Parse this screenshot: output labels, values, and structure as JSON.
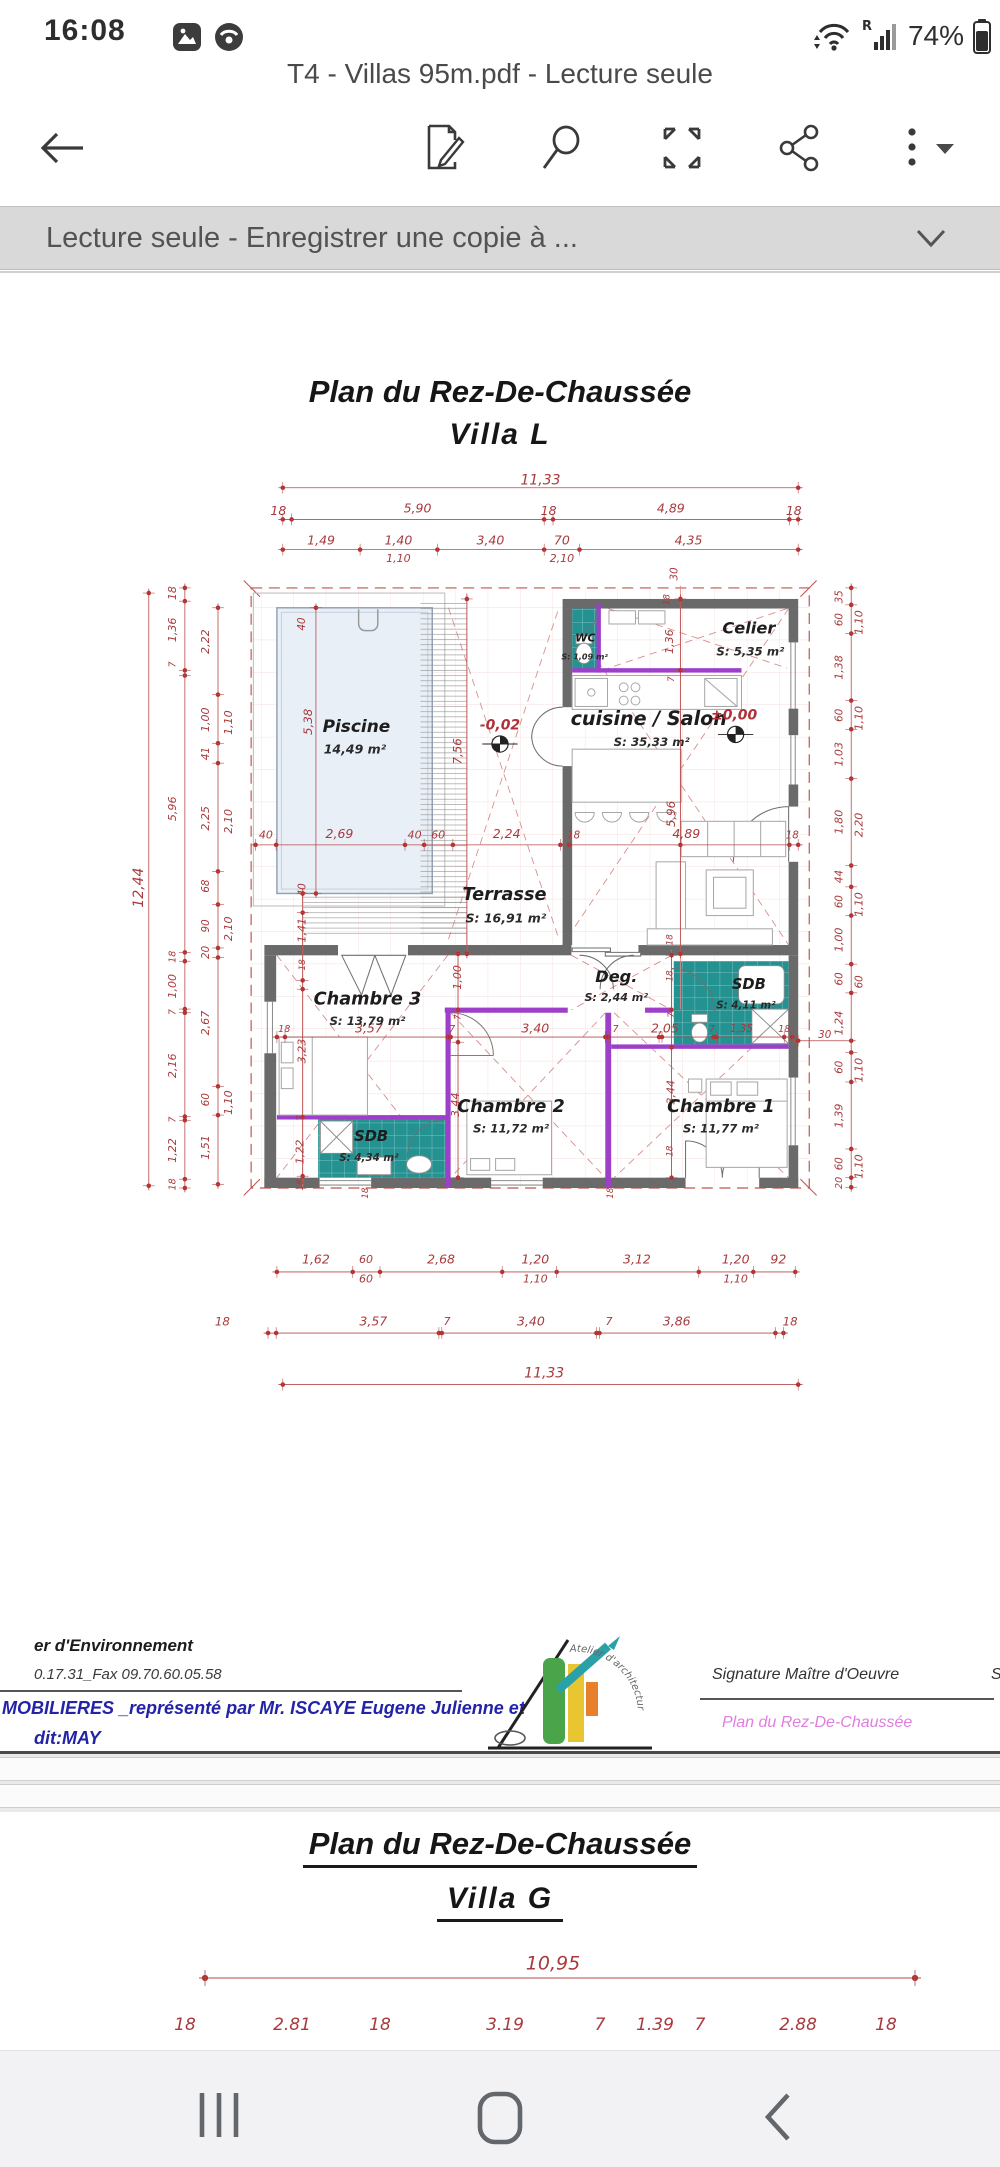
{
  "status_bar": {
    "time": "16:08",
    "battery_pct": "74%"
  },
  "window": {
    "title": "T4 - Villas 95m.pdf - Lecture seule"
  },
  "banner": {
    "label": "Lecture seule - Enregistrer une copie à ..."
  },
  "accent_colors": {
    "dim_red": "#a93a3c",
    "teal": "#259292",
    "purple": "#9d3fc9",
    "wall_gray": "#6a6a6a",
    "footer_blue": "#2323a8",
    "footer_pink": "#df7ede"
  },
  "page1": {
    "title": "Plan du Rez-De-Chaussée",
    "subtitle": "Villa  L"
  },
  "page2": {
    "title": "Plan du Rez-De-Chaussée",
    "subtitle": "Villa  G"
  },
  "rooms": [
    {
      "name": "Piscine",
      "nx": 305,
      "ny": 822,
      "ns": 23,
      "area": "14,49 m²",
      "ax": 303,
      "ay": 853,
      "as": 17
    },
    {
      "name": "WC",
      "nx": 616,
      "ny": 702,
      "ns": 15,
      "area": "S: 1,09 m²",
      "ax": 615,
      "ay": 727,
      "as": 11
    },
    {
      "name": "Celier",
      "nx": 838,
      "ny": 689,
      "ns": 22,
      "area": "S: 5,35 m²",
      "ax": 840,
      "ay": 720,
      "as": 16
    },
    {
      "name": "cuisine / Salon",
      "nx": 702,
      "ny": 812,
      "ns": 26,
      "area": "S: 35,33 m²",
      "ax": 706,
      "ay": 843,
      "as": 16
    },
    {
      "name": "Terrasse",
      "nx": 506,
      "ny": 1050,
      "ns": 24,
      "area": "S: 16,91 m²",
      "ax": 508,
      "ay": 1083,
      "as": 17
    },
    {
      "name": "Chambre 3",
      "nx": 320,
      "ny": 1192,
      "ns": 24,
      "area": "S: 13,79 m²",
      "ax": 320,
      "ay": 1222,
      "as": 16
    },
    {
      "name": "Deg.",
      "nx": 658,
      "ny": 1162,
      "ns": 22,
      "area": "S: 2,44 m²",
      "ax": 658,
      "ay": 1190,
      "as": 15
    },
    {
      "name": "SDB",
      "nx": 838,
      "ny": 1172,
      "ns": 20,
      "area": "S: 4,11 m²",
      "ax": 834,
      "ay": 1200,
      "as": 14
    },
    {
      "name": "Chambre 2",
      "nx": 515,
      "ny": 1338,
      "ns": 24,
      "area": "S: 11,72 m²",
      "ax": 515,
      "ay": 1368,
      "as": 16
    },
    {
      "name": "Chambre 1",
      "nx": 800,
      "ny": 1338,
      "ns": 24,
      "area": "S: 11,77 m²",
      "ax": 800,
      "ay": 1368,
      "as": 16
    },
    {
      "name": "SDB",
      "nx": 325,
      "ny": 1379,
      "ns": 20,
      "area": "S: 4,34 m²",
      "ax": 322,
      "ay": 1407,
      "as": 14
    }
  ],
  "levels": [
    {
      "t": "-0,02",
      "x": 500,
      "y": 820
    },
    {
      "t": "±0,00",
      "x": 818,
      "y": 806
    }
  ],
  "plan_dims": [
    {
      "t": "11,33",
      "x": 555,
      "y": 487,
      "s": 19
    },
    {
      "t": "18",
      "x": 199,
      "y": 529
    },
    {
      "t": "5,90",
      "x": 388,
      "y": 526
    },
    {
      "t": "18",
      "x": 566,
      "y": 529
    },
    {
      "t": "4,89",
      "x": 732,
      "y": 526
    },
    {
      "t": "18",
      "x": 899,
      "y": 529
    },
    {
      "t": "1,49",
      "x": 257,
      "y": 569
    },
    {
      "t": "1,40",
      "x": 362,
      "y": 569
    },
    {
      "t": "3,40",
      "x": 487,
      "y": 569
    },
    {
      "t": "70",
      "x": 584,
      "y": 569
    },
    {
      "t": "4,35",
      "x": 756,
      "y": 569
    },
    {
      "t": "1,10",
      "x": 362,
      "y": 594,
      "s": 15
    },
    {
      "t": "2,10",
      "x": 584,
      "y": 594,
      "s": 15
    },
    {
      "t": "30",
      "x": 737,
      "y": 614,
      "r": -90,
      "s": 14
    },
    {
      "t": "40",
      "x": 182,
      "y": 969,
      "s": 15
    },
    {
      "t": "2,69",
      "x": 282,
      "y": 968
    },
    {
      "t": "40",
      "x": 384,
      "y": 969,
      "s": 15
    },
    {
      "t": "60",
      "x": 416,
      "y": 969,
      "s": 15
    },
    {
      "t": "2,24",
      "x": 509,
      "y": 968
    },
    {
      "t": "18",
      "x": 600,
      "y": 969,
      "s": 14
    },
    {
      "t": "4,89",
      "x": 753,
      "y": 968
    },
    {
      "t": "18",
      "x": 897,
      "y": 969,
      "s": 14
    },
    {
      "t": "12,44",
      "x": 10,
      "y": 1040,
      "r": -90,
      "s": 19
    },
    {
      "t": "18",
      "x": 56,
      "y": 640,
      "r": -90,
      "s": 15
    },
    {
      "t": "1,36",
      "x": 56,
      "y": 690,
      "r": -90,
      "s": 15
    },
    {
      "t": "7",
      "x": 56,
      "y": 737,
      "r": -90,
      "s": 13
    },
    {
      "t": "5,96",
      "x": 56,
      "y": 933,
      "r": -90,
      "s": 15
    },
    {
      "t": "18",
      "x": 56,
      "y": 1134,
      "r": -90,
      "s": 13
    },
    {
      "t": "1,00",
      "x": 56,
      "y": 1174,
      "r": -90,
      "s": 15
    },
    {
      "t": "7",
      "x": 56,
      "y": 1209,
      "r": -90,
      "s": 13
    },
    {
      "t": "2,16",
      "x": 56,
      "y": 1282,
      "r": -90,
      "s": 15
    },
    {
      "t": "7",
      "x": 56,
      "y": 1355,
      "r": -90,
      "s": 13
    },
    {
      "t": "1,22",
      "x": 56,
      "y": 1397,
      "r": -90,
      "s": 15
    },
    {
      "t": "18",
      "x": 56,
      "y": 1443,
      "r": -90,
      "s": 13
    },
    {
      "t": "2,22",
      "x": 101,
      "y": 706,
      "r": -90,
      "s": 15
    },
    {
      "t": "1,00",
      "x": 101,
      "y": 812,
      "r": -90,
      "s": 15
    },
    {
      "t": "41",
      "x": 101,
      "y": 858,
      "r": -90,
      "s": 14
    },
    {
      "t": "2,25",
      "x": 101,
      "y": 946,
      "r": -90,
      "s": 15
    },
    {
      "t": "68",
      "x": 101,
      "y": 1038,
      "r": -90,
      "s": 14
    },
    {
      "t": "90",
      "x": 101,
      "y": 1092,
      "r": -90,
      "s": 14
    },
    {
      "t": "20",
      "x": 101,
      "y": 1128,
      "r": -90,
      "s": 14
    },
    {
      "t": "2,67",
      "x": 101,
      "y": 1224,
      "r": -90,
      "s": 15
    },
    {
      "t": "60",
      "x": 101,
      "y": 1328,
      "r": -90,
      "s": 14
    },
    {
      "t": "1,51",
      "x": 101,
      "y": 1393,
      "r": -90,
      "s": 15
    },
    {
      "t": "1,10",
      "x": 132,
      "y": 816,
      "r": -90,
      "s": 15
    },
    {
      "t": "2,10",
      "x": 132,
      "y": 950,
      "r": -90,
      "s": 15
    },
    {
      "t": "2,10",
      "x": 132,
      "y": 1096,
      "r": -90,
      "s": 15
    },
    {
      "t": "1,10",
      "x": 132,
      "y": 1332,
      "r": -90,
      "s": 15
    },
    {
      "t": "35",
      "x": 961,
      "y": 645,
      "r": -90,
      "s": 14
    },
    {
      "t": "60",
      "x": 961,
      "y": 676,
      "r": -90,
      "s": 14
    },
    {
      "t": "1,38",
      "x": 961,
      "y": 741,
      "r": -90,
      "s": 15
    },
    {
      "t": "60",
      "x": 961,
      "y": 806,
      "r": -90,
      "s": 14
    },
    {
      "t": "1,03",
      "x": 961,
      "y": 859,
      "r": -90,
      "s": 15
    },
    {
      "t": "1,80",
      "x": 961,
      "y": 951,
      "r": -90,
      "s": 15
    },
    {
      "t": "44",
      "x": 961,
      "y": 1025,
      "r": -90,
      "s": 14
    },
    {
      "t": "60",
      "x": 961,
      "y": 1059,
      "r": -90,
      "s": 14
    },
    {
      "t": "1,00",
      "x": 961,
      "y": 1111,
      "r": -90,
      "s": 15
    },
    {
      "t": "60",
      "x": 961,
      "y": 1164,
      "r": -90,
      "s": 14
    },
    {
      "t": "1,24",
      "x": 961,
      "y": 1224,
      "r": -90,
      "s": 15
    },
    {
      "t": "60",
      "x": 961,
      "y": 1284,
      "r": -90,
      "s": 14
    },
    {
      "t": "1,39",
      "x": 961,
      "y": 1350,
      "r": -90,
      "s": 15
    },
    {
      "t": "60",
      "x": 961,
      "y": 1415,
      "r": -90,
      "s": 14
    },
    {
      "t": "20",
      "x": 961,
      "y": 1441,
      "r": -90,
      "s": 13
    },
    {
      "t": "1,10",
      "x": 988,
      "y": 680,
      "r": -90,
      "s": 15
    },
    {
      "t": "1,10",
      "x": 988,
      "y": 810,
      "r": -90,
      "s": 15
    },
    {
      "t": "2,20",
      "x": 988,
      "y": 955,
      "r": -90,
      "s": 15
    },
    {
      "t": "1,10",
      "x": 988,
      "y": 1063,
      "r": -90,
      "s": 15
    },
    {
      "t": "60",
      "x": 988,
      "y": 1168,
      "r": -90,
      "s": 14
    },
    {
      "t": "1,10",
      "x": 988,
      "y": 1288,
      "r": -90,
      "s": 15
    },
    {
      "t": "1,10",
      "x": 988,
      "y": 1419,
      "r": -90,
      "s": 15
    },
    {
      "t": "30",
      "x": 941,
      "y": 1240,
      "s": 14
    },
    {
      "t": "40",
      "x": 231,
      "y": 682,
      "r": -90,
      "s": 14
    },
    {
      "t": "5,38",
      "x": 240,
      "y": 815,
      "r": -90,
      "s": 16
    },
    {
      "t": "7,56",
      "x": 443,
      "y": 855,
      "r": -90,
      "s": 16
    },
    {
      "t": "40",
      "x": 232,
      "y": 1043,
      "r": -90,
      "s": 14
    },
    {
      "t": "1,41",
      "x": 232,
      "y": 1098,
      "r": -90,
      "s": 15
    },
    {
      "t": "18",
      "x": 232,
      "y": 1145,
      "r": -90,
      "s": 12
    },
    {
      "t": "18",
      "x": 727,
      "y": 649,
      "r": -90,
      "s": 12
    },
    {
      "t": "1,36",
      "x": 731,
      "y": 706,
      "r": -90,
      "s": 15
    },
    {
      "t": "7",
      "x": 733,
      "y": 757,
      "r": -90,
      "s": 12
    },
    {
      "t": "5,96",
      "x": 733,
      "y": 940,
      "r": -90,
      "s": 16
    },
    {
      "t": "18",
      "x": 731,
      "y": 1111,
      "r": -90,
      "s": 12
    },
    {
      "t": "18",
      "x": 731,
      "y": 1160,
      "r": -90,
      "s": 12
    },
    {
      "t": "7",
      "x": 733,
      "y": 1213,
      "r": -90,
      "s": 12
    },
    {
      "t": "3,44",
      "x": 733,
      "y": 1318,
      "r": -90,
      "s": 15
    },
    {
      "t": "1,00",
      "x": 443,
      "y": 1162,
      "r": -90,
      "s": 15
    },
    {
      "t": "7",
      "x": 443,
      "y": 1216,
      "r": -90,
      "s": 12
    },
    {
      "t": "3,44",
      "x": 440,
      "y": 1335,
      "r": -90,
      "s": 15
    },
    {
      "t": "3,23",
      "x": 232,
      "y": 1262,
      "r": -90,
      "s": 15
    },
    {
      "t": "7",
      "x": 229,
      "y": 1353,
      "r": -90,
      "s": 12
    },
    {
      "t": "1,22",
      "x": 229,
      "y": 1399,
      "r": -90,
      "s": 15
    },
    {
      "t": "18",
      "x": 229,
      "y": 1444,
      "r": -90,
      "s": 12
    },
    {
      "t": "18",
      "x": 317,
      "y": 1455,
      "r": -90,
      "s": 12
    },
    {
      "t": "18",
      "x": 650,
      "y": 1455,
      "r": -90,
      "s": 12
    },
    {
      "t": "18",
      "x": 731,
      "y": 1398,
      "r": -90,
      "s": 12
    },
    {
      "t": "18",
      "x": 207,
      "y": 1233,
      "s": 13
    },
    {
      "t": "3,57",
      "x": 322,
      "y": 1232
    },
    {
      "t": "7",
      "x": 435,
      "y": 1233,
      "s": 13
    },
    {
      "t": "3,40",
      "x": 548,
      "y": 1232
    },
    {
      "t": "7",
      "x": 657,
      "y": 1233,
      "s": 13
    },
    {
      "t": "2,05",
      "x": 724,
      "y": 1232
    },
    {
      "t": "7",
      "x": 788,
      "y": 1233,
      "s": 13
    },
    {
      "t": "1,35",
      "x": 828,
      "y": 1232,
      "s": 14
    },
    {
      "t": "18",
      "x": 886,
      "y": 1233,
      "s": 13
    },
    {
      "t": "1,62",
      "x": 250,
      "y": 1546
    },
    {
      "t": "60",
      "x": 318,
      "y": 1546,
      "s": 15
    },
    {
      "t": "2,68",
      "x": 420,
      "y": 1546
    },
    {
      "t": "1,20",
      "x": 548,
      "y": 1546
    },
    {
      "t": "3,12",
      "x": 686,
      "y": 1546
    },
    {
      "t": "1,20",
      "x": 820,
      "y": 1546
    },
    {
      "t": "92",
      "x": 878,
      "y": 1546
    },
    {
      "t": "60",
      "x": 318,
      "y": 1572,
      "s": 15
    },
    {
      "t": "1,10",
      "x": 548,
      "y": 1572,
      "s": 15
    },
    {
      "t": "1,10",
      "x": 820,
      "y": 1572,
      "s": 15
    },
    {
      "t": "18",
      "x": 123,
      "y": 1630,
      "s": 16
    },
    {
      "t": "3,57",
      "x": 328,
      "y": 1630
    },
    {
      "t": "7",
      "x": 428,
      "y": 1630,
      "s": 15
    },
    {
      "t": "3,40",
      "x": 542,
      "y": 1630
    },
    {
      "t": "7",
      "x": 648,
      "y": 1630,
      "s": 15
    },
    {
      "t": "3,86",
      "x": 740,
      "y": 1630
    },
    {
      "t": "18",
      "x": 894,
      "y": 1630,
      "s": 16
    },
    {
      "t": "11,33",
      "x": 560,
      "y": 1700,
      "s": 19
    }
  ],
  "plan2_dims": [
    {
      "t": "10,95",
      "x": 553,
      "y": 1964,
      "s": 19
    },
    {
      "t": "18",
      "x": 185,
      "y": 2025
    },
    {
      "t": "2.81",
      "x": 292,
      "y": 2025
    },
    {
      "t": "18",
      "x": 380,
      "y": 2025
    },
    {
      "t": "3.19",
      "x": 505,
      "y": 2025
    },
    {
      "t": "7",
      "x": 600,
      "y": 2025
    },
    {
      "t": "1.39",
      "x": 655,
      "y": 2025
    },
    {
      "t": "7",
      "x": 700,
      "y": 2025
    },
    {
      "t": "2.88",
      "x": 798,
      "y": 2025
    },
    {
      "t": "18",
      "x": 886,
      "y": 2025
    }
  ],
  "footer": {
    "line1": "er d'Environnement",
    "line2": "0.17.31_Fax 09.70.60.05.58",
    "blue1": "MOBILIERES _représenté par Mr. ISCAYE Eugene Julienne et",
    "blue2": "dit:MAY",
    "sig_label": "Signature Maître d'Oeuvre",
    "sig_plan": "Plan du Rez-De-Chaussée",
    "sig_right": "S",
    "logo_arc_text": "Atelier d'architecture"
  }
}
